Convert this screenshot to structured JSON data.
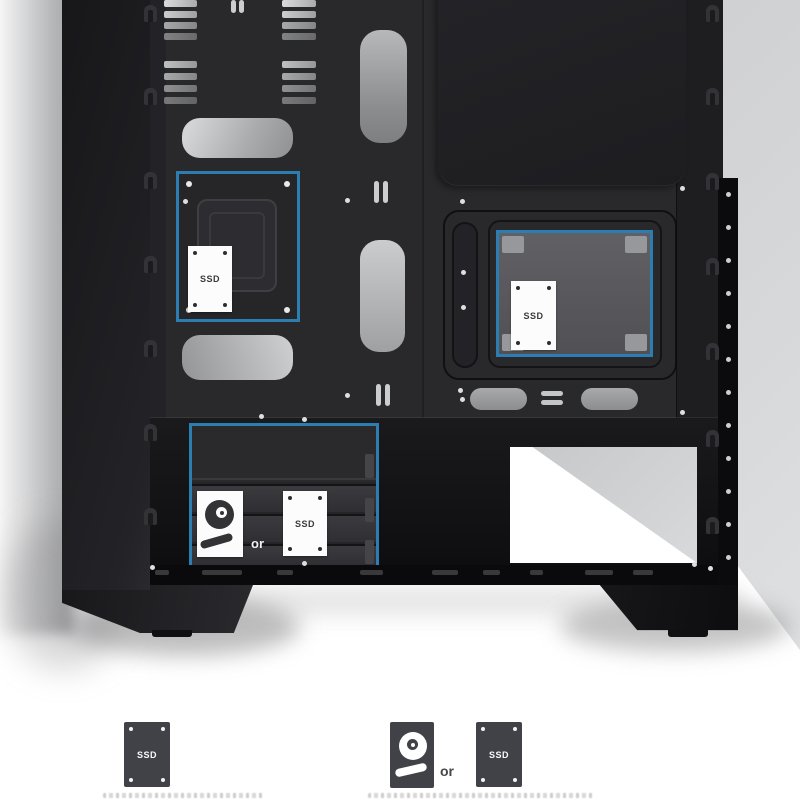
{
  "diagram": {
    "accent_blue": "#2b7db2",
    "mount_top_left": {
      "ssd_label": "SSD"
    },
    "mount_right": {
      "ssd_label": "SSD"
    },
    "drive_cage": {
      "or_label": "or",
      "ssd_label": "SSD"
    },
    "legend": {
      "ssd_bracket_label": "SSD",
      "hdd_or_ssd": {
        "or_label": "or",
        "ssd_label": "SSD"
      }
    }
  }
}
